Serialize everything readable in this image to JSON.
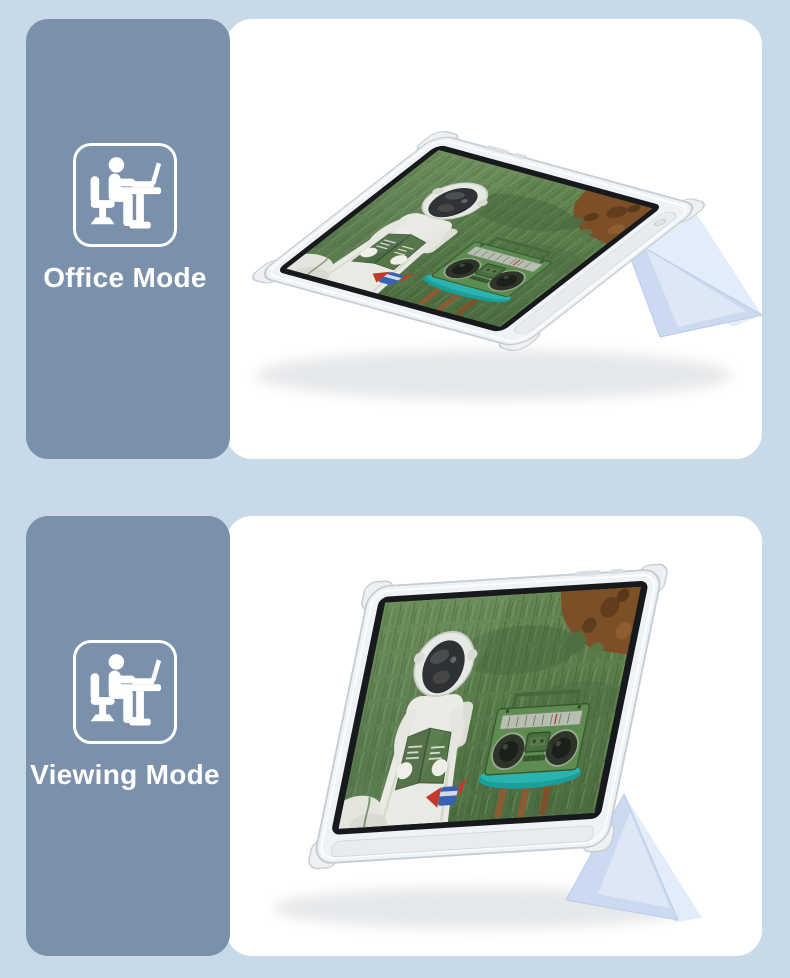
{
  "product_collage": {
    "background_color": "#c8d9e8",
    "panel_color": "#7b90aa",
    "card_color": "#ffffff",
    "stand_color": "#cbdaf0",
    "label_color": "#ffffff",
    "screen_scene": "astronaut-reading-green-book-in-grassy-field-with-green-boombox-on-teal-table",
    "sections": [
      {
        "label": "Office Mode",
        "icon": "person-working-at-desk-icon",
        "photo": "tablet-in-clear-case-reclined-at-low-angle-on-folded-light-blue-stand"
      },
      {
        "label": "Viewing Mode",
        "icon": "person-working-at-desk-icon",
        "photo": "tablet-in-clear-case-propped-upright-on-folded-light-blue-stand"
      }
    ]
  }
}
